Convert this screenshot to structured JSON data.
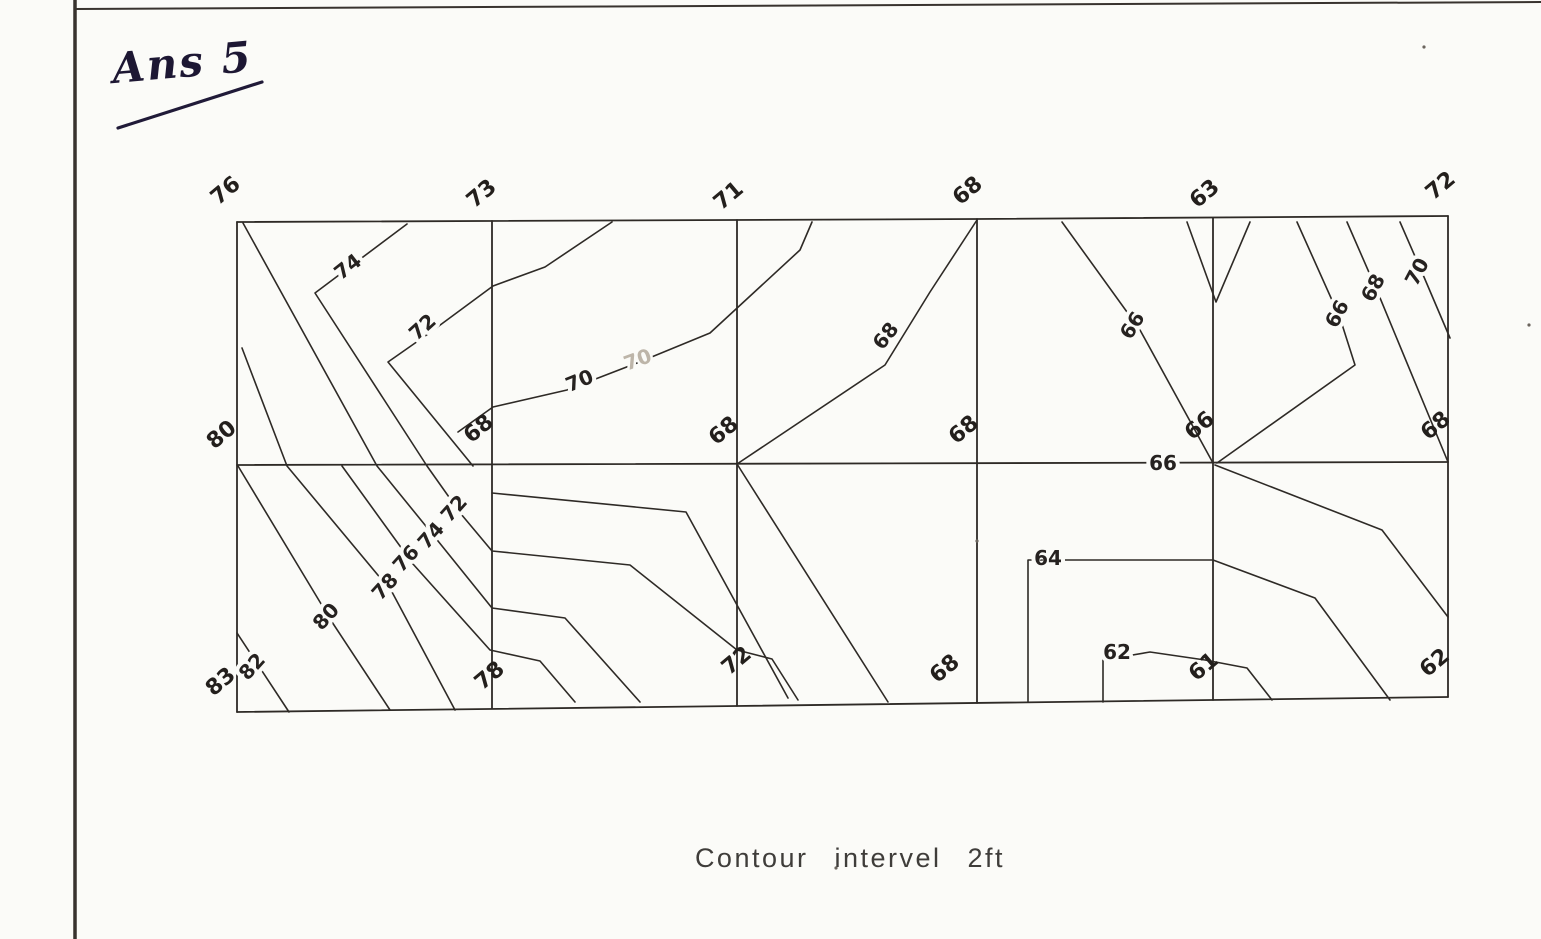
{
  "page": {
    "answer_tag": "Ans 5",
    "caption": "Contour intervel 2ft",
    "paper_color": "#fbfbf8",
    "ink_color": "#2e2a26"
  },
  "map": {
    "contour_interval_ft": 2,
    "stations": {
      "columns_x": [
        237,
        492,
        737,
        977,
        1213,
        1448
      ],
      "rows": [
        {
          "row": "top",
          "values": [
            76,
            73,
            71,
            68,
            63,
            72
          ]
        },
        {
          "row": "middle",
          "values": [
            80,
            68,
            68,
            68,
            66,
            68
          ]
        },
        {
          "row": "bottom",
          "values": [
            83,
            78,
            72,
            68,
            61,
            62
          ]
        }
      ]
    },
    "grid": {
      "lines": [
        {
          "name": "grid-top-edge",
          "points": [
            [
              237,
              222
            ],
            [
              977,
              219
            ],
            [
              1448,
              216
            ]
          ]
        },
        {
          "name": "grid-middle-line",
          "points": [
            [
              237,
              465
            ],
            [
              1448,
              462
            ]
          ]
        },
        {
          "name": "grid-bottom-edge",
          "points": [
            [
              237,
              712
            ],
            [
              737,
              706
            ],
            [
              1448,
              697
            ]
          ]
        },
        {
          "name": "grid-vertical-1",
          "points": [
            [
              237,
              222
            ],
            [
              237,
              712
            ]
          ]
        },
        {
          "name": "grid-vertical-2",
          "points": [
            [
              492,
              221
            ],
            [
              492,
              708
            ]
          ]
        },
        {
          "name": "grid-vertical-3",
          "points": [
            [
              737,
              220
            ],
            [
              737,
              706
            ]
          ]
        },
        {
          "name": "grid-vertical-4",
          "points": [
            [
              977,
              219
            ],
            [
              977,
              703
            ]
          ]
        },
        {
          "name": "grid-vertical-5",
          "points": [
            [
              1213,
              218
            ],
            [
              1213,
              700
            ]
          ]
        },
        {
          "name": "grid-vertical-6",
          "points": [
            [
              1448,
              216
            ],
            [
              1448,
              697
            ]
          ]
        }
      ]
    },
    "contours": [
      {
        "labels": [
          "74",
          "72"
        ],
        "points": [
          [
            407,
            224
          ],
          [
            315,
            293
          ],
          [
            427,
            466
          ],
          [
            461,
            514
          ],
          [
            492,
            551
          ],
          [
            630,
            565
          ],
          [
            737,
            650
          ],
          [
            772,
            659
          ],
          [
            798,
            700
          ]
        ]
      },
      {
        "labels": [
          "72"
        ],
        "points": [
          [
            612,
            222
          ],
          [
            545,
            267
          ],
          [
            493,
            286
          ],
          [
            428,
            334
          ],
          [
            388,
            362
          ],
          [
            473,
            466
          ]
        ]
      },
      {
        "labels": [
          "74"
        ],
        "points": [
          [
            243,
            223
          ],
          [
            377,
            466
          ],
          [
            438,
            541
          ],
          [
            492,
            608
          ],
          [
            565,
            618
          ],
          [
            640,
            702
          ]
        ]
      },
      {
        "labels": [
          "76"
        ],
        "points": [
          [
            342,
            466
          ],
          [
            413,
            564
          ],
          [
            490,
            650
          ],
          [
            540,
            661
          ],
          [
            575,
            702
          ]
        ]
      },
      {
        "labels": [
          "78"
        ],
        "points": [
          [
            242,
            348
          ],
          [
            287,
            466
          ],
          [
            392,
            592
          ],
          [
            455,
            710
          ]
        ]
      },
      {
        "labels": [
          "80"
        ],
        "points": [
          [
            238,
            466
          ],
          [
            332,
            622
          ],
          [
            390,
            710
          ]
        ]
      },
      {
        "labels": [
          "82"
        ],
        "points": [
          [
            237,
            633
          ],
          [
            289,
            712
          ]
        ]
      },
      {
        "labels": [
          "70"
        ],
        "points": [
          [
            458,
            432
          ],
          [
            493,
            407
          ],
          [
            567,
            390
          ],
          [
            637,
            363
          ],
          [
            710,
            333
          ],
          [
            800,
            250
          ],
          [
            812,
            222
          ]
        ]
      },
      {
        "labels": [],
        "points": [
          [
            492,
            493
          ],
          [
            686,
            512
          ],
          [
            788,
            698
          ]
        ]
      },
      {
        "labels": [
          "68"
        ],
        "points": [
          [
            977,
            220
          ],
          [
            930,
            292
          ],
          [
            885,
            365
          ],
          [
            737,
            464
          ],
          [
            888,
            702
          ]
        ]
      },
      {
        "labels": [
          "66"
        ],
        "points": [
          [
            1062,
            222
          ],
          [
            1140,
            330
          ],
          [
            1213,
            463
          ]
        ]
      },
      {
        "labels": [],
        "points": [
          [
            1187,
            222
          ],
          [
            1216,
            302
          ],
          [
            1250,
            222
          ]
        ]
      },
      {
        "labels": [
          "66"
        ],
        "points": [
          [
            1297,
            222
          ],
          [
            1340,
            318
          ],
          [
            1355,
            365
          ],
          [
            1217,
            463
          ]
        ]
      },
      {
        "labels": [
          "68"
        ],
        "points": [
          [
            1347,
            222
          ],
          [
            1378,
            293
          ],
          [
            1448,
            462
          ]
        ]
      },
      {
        "labels": [
          "70"
        ],
        "points": [
          [
            1400,
            222
          ],
          [
            1424,
            277
          ],
          [
            1450,
            338
          ]
        ]
      },
      {
        "labels": [
          "66"
        ],
        "points": [
          [
            1215,
            465
          ],
          [
            1382,
            530
          ],
          [
            1448,
            617
          ]
        ]
      },
      {
        "labels": [
          "64"
        ],
        "points": [
          [
            1028,
            702
          ],
          [
            1028,
            560
          ],
          [
            1213,
            560
          ],
          [
            1315,
            598
          ],
          [
            1390,
            700
          ]
        ]
      },
      {
        "labels": [
          "62"
        ],
        "points": [
          [
            1103,
            702
          ],
          [
            1103,
            660
          ],
          [
            1150,
            652
          ],
          [
            1205,
            660
          ],
          [
            1247,
            668
          ],
          [
            1272,
            700
          ]
        ]
      }
    ],
    "contour_labels": [
      {
        "text": "74",
        "x": 352,
        "y": 272,
        "rot": -38,
        "faint": false
      },
      {
        "text": "72",
        "x": 427,
        "y": 332,
        "rot": -42,
        "faint": false
      },
      {
        "text": "70",
        "x": 582,
        "y": 387,
        "rot": -22,
        "faint": false
      },
      {
        "text": "70",
        "x": 640,
        "y": 366,
        "rot": -20,
        "faint": true
      },
      {
        "text": "68",
        "x": 891,
        "y": 340,
        "rot": -52,
        "faint": false
      },
      {
        "text": "66",
        "x": 1138,
        "y": 329,
        "rot": -58,
        "faint": false
      },
      {
        "text": "66",
        "x": 1343,
        "y": 317,
        "rot": -62,
        "faint": false
      },
      {
        "text": "68",
        "x": 1379,
        "y": 291,
        "rot": -62,
        "faint": false
      },
      {
        "text": "70",
        "x": 1423,
        "y": 275,
        "rot": -62,
        "faint": false
      },
      {
        "text": "72",
        "x": 459,
        "y": 513,
        "rot": -48,
        "faint": false
      },
      {
        "text": "74",
        "x": 436,
        "y": 540,
        "rot": -48,
        "faint": false
      },
      {
        "text": "76",
        "x": 411,
        "y": 563,
        "rot": -48,
        "faint": false
      },
      {
        "text": "78",
        "x": 390,
        "y": 591,
        "rot": -48,
        "faint": false
      },
      {
        "text": "80",
        "x": 331,
        "y": 621,
        "rot": -48,
        "faint": false
      },
      {
        "text": "82",
        "x": 257,
        "y": 671,
        "rot": -48,
        "faint": false
      },
      {
        "text": "64",
        "x": 1048,
        "y": 565,
        "rot": 0,
        "faint": false
      },
      {
        "text": "62",
        "x": 1117,
        "y": 659,
        "rot": 0,
        "faint": false
      },
      {
        "text": "66",
        "x": 1163,
        "y": 470,
        "rot": 0,
        "faint": false
      }
    ],
    "station_labels": [
      {
        "text": "76",
        "x": 230,
        "y": 196,
        "rot": -40
      },
      {
        "text": "73",
        "x": 486,
        "y": 199,
        "rot": -40
      },
      {
        "text": "71",
        "x": 733,
        "y": 201,
        "rot": -40
      },
      {
        "text": "68",
        "x": 972,
        "y": 196,
        "rot": -40
      },
      {
        "text": "63",
        "x": 1209,
        "y": 199,
        "rot": -40
      },
      {
        "text": "72",
        "x": 1445,
        "y": 191,
        "rot": -40
      },
      {
        "text": "80",
        "x": 226,
        "y": 440,
        "rot": -40
      },
      {
        "text": "68",
        "x": 483,
        "y": 434,
        "rot": -40
      },
      {
        "text": "68",
        "x": 728,
        "y": 436,
        "rot": -40
      },
      {
        "text": "68",
        "x": 968,
        "y": 435,
        "rot": -40
      },
      {
        "text": "66",
        "x": 1204,
        "y": 431,
        "rot": -40
      },
      {
        "text": "68",
        "x": 1440,
        "y": 431,
        "rot": -40
      },
      {
        "text": "83",
        "x": 225,
        "y": 687,
        "rot": -40
      },
      {
        "text": "78",
        "x": 494,
        "y": 681,
        "rot": -40
      },
      {
        "text": "72",
        "x": 741,
        "y": 666,
        "rot": -40
      },
      {
        "text": "68",
        "x": 949,
        "y": 674,
        "rot": -40
      },
      {
        "text": "61",
        "x": 1208,
        "y": 672,
        "rot": -40
      },
      {
        "text": "62",
        "x": 1439,
        "y": 668,
        "rot": -40
      }
    ],
    "page_border": {
      "left_edge": [
        [
          75,
          0
        ],
        [
          75,
          939
        ]
      ],
      "top_edge": [
        [
          75,
          9
        ],
        [
          1541,
          2
        ]
      ]
    },
    "underline": [
      [
        118,
        128
      ],
      [
        262,
        82
      ]
    ],
    "speckles": [
      [
        1529,
        325
      ],
      [
        977,
        541
      ],
      [
        1424,
        47
      ],
      [
        836,
        868
      ]
    ]
  }
}
